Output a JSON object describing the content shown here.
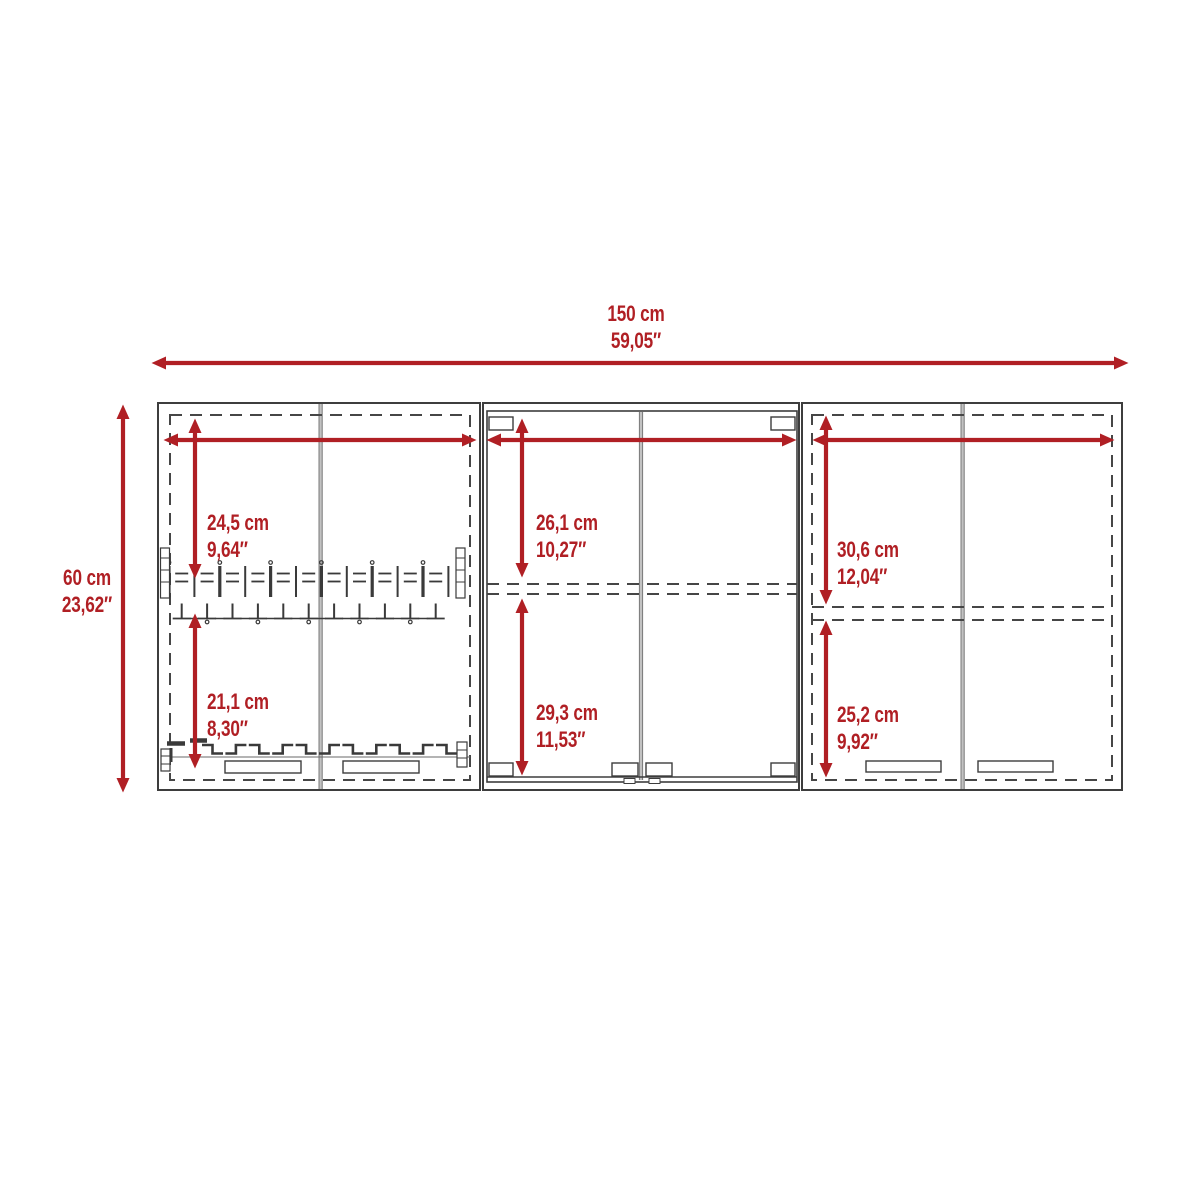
{
  "diagram_title": "Wall cabinet dimensioned front elevation",
  "colors": {
    "accent": "#b01f24",
    "line": "#3d3d3d",
    "divider": "#c2c2c2",
    "background": "#ffffff"
  },
  "dims": {
    "overall_width": {
      "cm": "150 cm",
      "inches": "59,05″"
    },
    "overall_height": {
      "cm": "60 cm",
      "inches": "23,62″"
    },
    "left_upper": {
      "cm": "24,5 cm",
      "inches": "9,64″"
    },
    "left_lower": {
      "cm": "21,1 cm",
      "inches": "8,30″"
    },
    "middle_upper": {
      "cm": "26,1 cm",
      "inches": "10,27″"
    },
    "middle_lower": {
      "cm": "29,3 cm",
      "inches": "11,53″"
    },
    "right_upper": {
      "cm": "30,6 cm",
      "inches": "12,04″"
    },
    "right_lower": {
      "cm": "25,2 cm",
      "inches": "9,92″"
    }
  }
}
